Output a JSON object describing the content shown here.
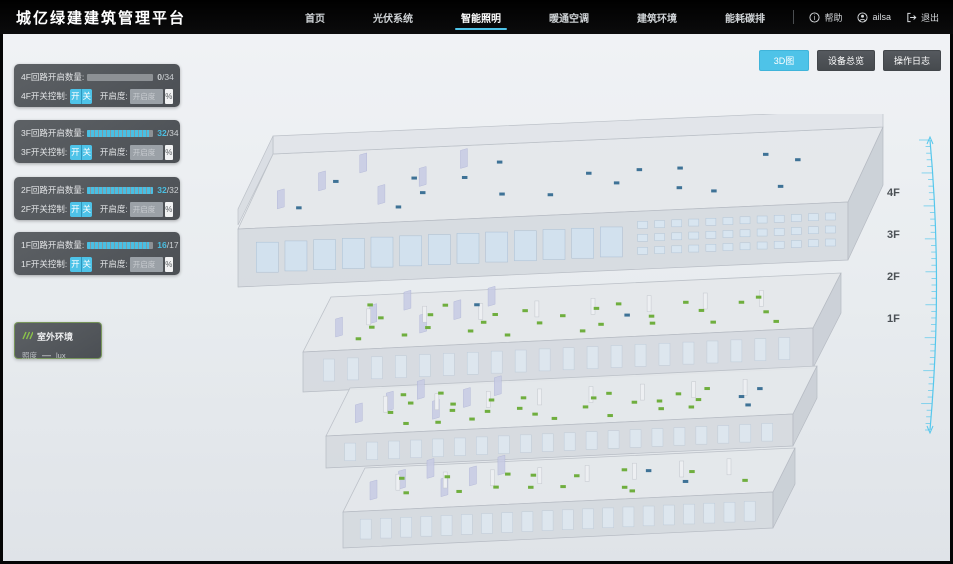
{
  "app": {
    "title": "城亿绿建建筑管理平台"
  },
  "nav": {
    "items": [
      {
        "label": "首页"
      },
      {
        "label": "光伏系统"
      },
      {
        "label": "智能照明",
        "active": true
      },
      {
        "label": "暖通空调"
      },
      {
        "label": "建筑环境"
      },
      {
        "label": "能耗碳排"
      }
    ],
    "help": "帮助",
    "user": "ailsa",
    "logout": "退出"
  },
  "view_buttons": [
    {
      "label": "3D图",
      "active": true
    },
    {
      "label": "设备总览",
      "active": false
    },
    {
      "label": "操作日志",
      "active": false
    }
  ],
  "floor_panels": [
    {
      "count_label": "4F回路开启数量:",
      "count_on": "0",
      "count_den": "/34",
      "fraction": 0,
      "num_color": "#c9cdd0",
      "switch_label": "4F开关控制:",
      "on_btn": "开",
      "off_btn": "关",
      "dim_label": "开启度:",
      "dim_placeholder": "开启度",
      "percent": "%"
    },
    {
      "count_label": "3F回路开启数量:",
      "count_on": "32",
      "count_den": "/34",
      "fraction": 0.94,
      "num_color": "#49bfe3",
      "switch_label": "3F开关控制:",
      "on_btn": "开",
      "off_btn": "关",
      "dim_label": "开启度:",
      "dim_placeholder": "开启度",
      "percent": "%"
    },
    {
      "count_label": "2F回路开启数量:",
      "count_on": "32",
      "count_den": "/32",
      "fraction": 1,
      "num_color": "#49bfe3",
      "switch_label": "2F开关控制:",
      "on_btn": "开",
      "off_btn": "关",
      "dim_label": "开启度:",
      "dim_placeholder": "开启度",
      "percent": "%"
    },
    {
      "count_label": "1F回路开启数量:",
      "count_on": "16",
      "count_den": "/17",
      "fraction": 0.94,
      "num_color": "#49bfe3",
      "switch_label": "1F开关控制:",
      "on_btn": "开",
      "off_btn": "关",
      "dim_label": "开启度:",
      "dim_placeholder": "开启度",
      "percent": "%"
    }
  ],
  "outdoor": {
    "title": "室外环境",
    "metric_label": "照度",
    "metric_value": "—",
    "metric_unit": "lux"
  },
  "building": {
    "floors": [
      {
        "name": "4F",
        "lights_on": 0,
        "lights_off": 18
      },
      {
        "name": "3F",
        "lights_on": 28,
        "lights_off": 2
      },
      {
        "name": "2F",
        "lights_on": 26,
        "lights_off": 3
      },
      {
        "name": "1F",
        "lights_on": 15,
        "lights_off": 2
      }
    ]
  },
  "floor_labels": [
    "4F",
    "3F",
    "2F",
    "1F"
  ],
  "legend": [
    {
      "label": "开启",
      "color": "#85b94e"
    },
    {
      "label": "关闭",
      "color": "#6f9fd8"
    }
  ],
  "bulk_buttons": [
    {
      "label": "全楼一键开"
    },
    {
      "label": "全楼一键关"
    }
  ],
  "colors": {
    "accent": "#4ec3e8",
    "light_on": "#6fae3e",
    "light_off": "#3e7296",
    "ruler": "#55c7ec"
  }
}
